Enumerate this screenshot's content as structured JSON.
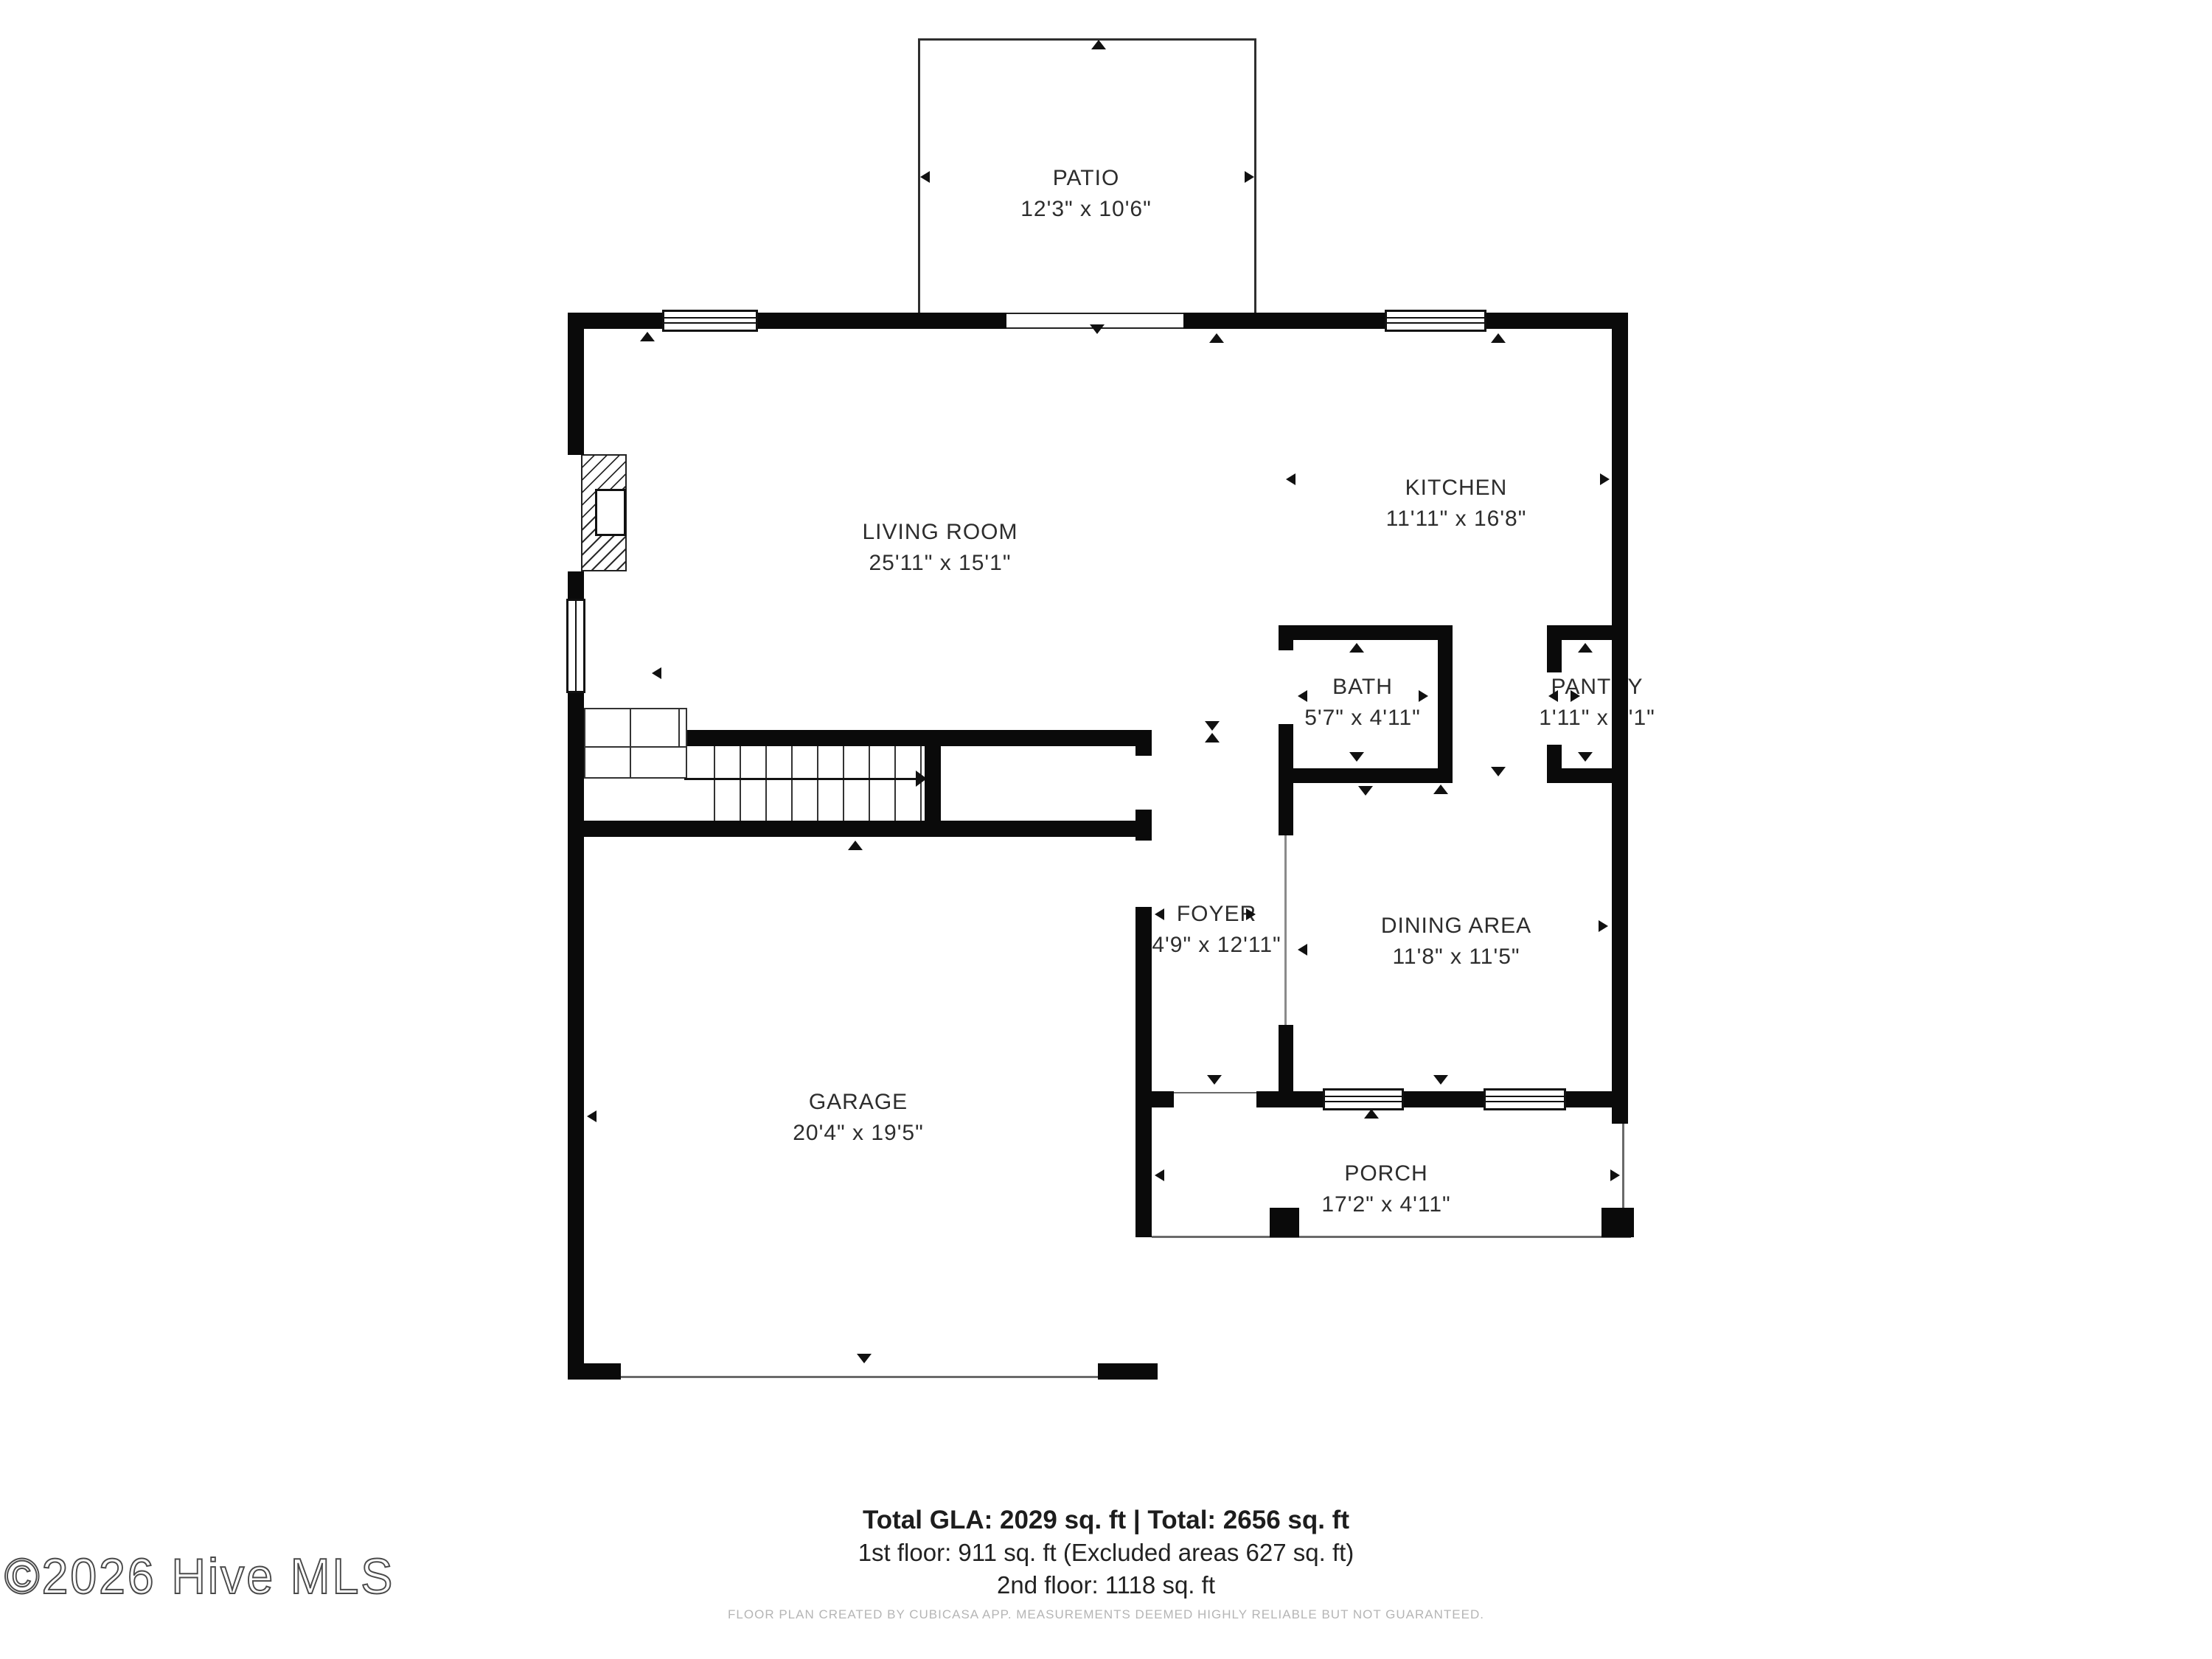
{
  "rooms": [
    {
      "name": "PATIO",
      "dims": "12'3\" x 10'6\""
    },
    {
      "name": "LIVING ROOM",
      "dims": "25'11\" x 15'1\""
    },
    {
      "name": "KITCHEN",
      "dims": "11'11\" x 16'8\""
    },
    {
      "name": "BATH",
      "dims": "5'7\" x 4'11\""
    },
    {
      "name": "PANTRY",
      "dims": "1'11\" x 4'1\""
    },
    {
      "name": "FOYER",
      "dims": "4'9\" x 12'11\""
    },
    {
      "name": "DINING AREA",
      "dims": "11'8\" x 11'5\""
    },
    {
      "name": "GARAGE",
      "dims": "20'4\" x 19'5\""
    },
    {
      "name": "PORCH",
      "dims": "17'2\" x 4'11\""
    }
  ],
  "summary": {
    "total_line": "Total GLA: 2029 sq. ft | Total: 2656 sq. ft",
    "first_floor_line": "1st floor: 911 sq. ft (Excluded areas 627 sq. ft)",
    "second_floor_line": "2nd floor: 1118 sq. ft"
  },
  "footer": {
    "disclaimer": "FLOOR PLAN CREATED BY CUBICASA APP. MEASUREMENTS DEEMED HIGHLY RELIABLE BUT NOT GUARANTEED."
  },
  "watermark": {
    "text": "©2026 Hive MLS"
  },
  "colors": {
    "wall": "#0a0a0a",
    "label": "#2d2d2d",
    "muted": "#b5b5b5",
    "thin_line": "#6a6a6a"
  }
}
